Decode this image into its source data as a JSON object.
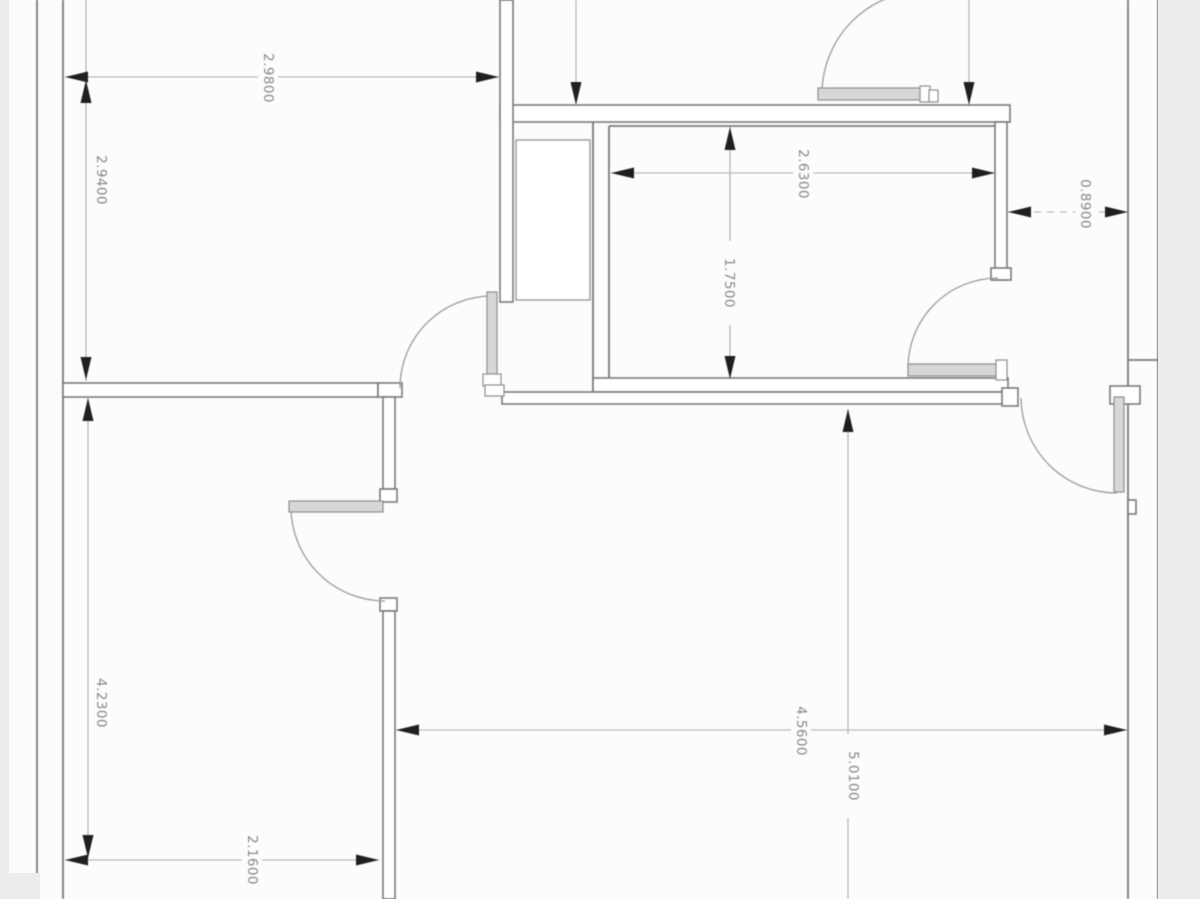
{
  "title": "floor-plan-drawing",
  "colors": {
    "background": "#fcfcfc",
    "paper_edge": "#ececec",
    "wall_stroke": "#7a7a7a",
    "thin_line": "#9b9b9b",
    "dim_line": "#aeaeae",
    "arrow": "#1f1f1f",
    "text": "#878787",
    "leaf_fill": "#d7d7d7",
    "leaf_stroke": "#8f8f8f"
  },
  "paper_edges": [
    {
      "name": "paper-edge-left",
      "x": 0,
      "y": 0,
      "w": 9,
      "h": 899
    },
    {
      "name": "paper-edge-right",
      "x": 1158,
      "y": 0,
      "w": 42,
      "h": 899
    },
    {
      "name": "paper-edge-bottom-left",
      "x": 0,
      "y": 873,
      "w": 40,
      "h": 26
    }
  ],
  "wall_lines": [
    {
      "name": "outer-left-wall-outer-line",
      "x1": 37,
      "y1": 0,
      "x2": 37,
      "y2": 899
    },
    {
      "name": "outer-left-wall-inner-line",
      "x1": 63,
      "y1": 0,
      "x2": 63,
      "y2": 899
    },
    {
      "name": "outer-right-wall-inner-line",
      "x1": 1128,
      "y1": 0,
      "x2": 1128,
      "y2": 899
    },
    {
      "name": "outer-right-wall-outer-line",
      "x1": 1158,
      "y1": 0,
      "x2": 1158,
      "y2": 899
    },
    {
      "name": "bathroom-top-inner-line",
      "x1": 609,
      "y1": 126,
      "x2": 995,
      "y2": 126
    },
    {
      "name": "bathroom-left-inner-line",
      "x1": 609,
      "y1": 126,
      "x2": 609,
      "y2": 380
    },
    {
      "name": "bathroom-left-outer-line",
      "x1": 593,
      "y1": 122,
      "x2": 593,
      "y2": 392
    },
    {
      "name": "right-wall-tick",
      "x1": 1128,
      "y1": 360,
      "x2": 1158,
      "y2": 360
    }
  ],
  "wall_rects": [
    {
      "name": "top-wall",
      "x": 500,
      "y": 105,
      "w": 510,
      "h": 17
    },
    {
      "name": "top-vertical-wall",
      "x": 500,
      "y": 0,
      "w": 13,
      "h": 302
    },
    {
      "name": "bedroom1-bottom-wall",
      "x": 63,
      "y": 383,
      "w": 315,
      "h": 14
    },
    {
      "name": "bedroom1-door-jamb",
      "x": 378,
      "y": 383,
      "w": 24,
      "h": 14
    },
    {
      "name": "middle-vertical-wall-upper",
      "x": 383,
      "y": 397,
      "w": 12,
      "h": 92
    },
    {
      "name": "bedroom2-door-top-jamb",
      "x": 380,
      "y": 489,
      "w": 17,
      "h": 13
    },
    {
      "name": "bedroom2-door-bottom-jamb",
      "x": 380,
      "y": 598,
      "w": 17,
      "h": 13
    },
    {
      "name": "middle-vertical-wall-lower",
      "x": 383,
      "y": 611,
      "w": 12,
      "h": 288
    },
    {
      "name": "bathroom-bottom-wall",
      "x": 593,
      "y": 378,
      "w": 415,
      "h": 14
    },
    {
      "name": "corridor-wall",
      "x": 502,
      "y": 392,
      "w": 514,
      "h": 12
    },
    {
      "name": "corridor-wall-right-jamb",
      "x": 1002,
      "y": 388,
      "w": 16,
      "h": 18
    },
    {
      "name": "bathroom-right-wall",
      "x": 995,
      "y": 122,
      "w": 12,
      "h": 158
    },
    {
      "name": "bathroom-right-wall-jamb",
      "x": 991,
      "y": 268,
      "w": 20,
      "h": 12
    },
    {
      "name": "entry-door-hinge-stub",
      "x": 1110,
      "y": 386,
      "w": 30,
      "h": 18
    },
    {
      "name": "right-wall-step",
      "x": 1128,
      "y": 500,
      "w": 8,
      "h": 14
    }
  ],
  "closet": {
    "name": "closet",
    "x": 516,
    "y": 140,
    "w": 74,
    "h": 160
  },
  "doors": [
    {
      "name": "door-top-right-room",
      "leaf": {
        "x": 818,
        "y": 88,
        "w": 104,
        "h": 12
      },
      "blocks": [
        {
          "x": 920,
          "y": 86,
          "w": 10,
          "h": 16
        },
        {
          "x": 929,
          "y": 90,
          "w": 9,
          "h": 12
        }
      ],
      "arc": "M 822,94 A 103,103 0 0 1 925,-9"
    },
    {
      "name": "door-bedroom1",
      "leaf": {
        "x": 487,
        "y": 292,
        "w": 10,
        "h": 92
      },
      "blocks": [
        {
          "x": 483,
          "y": 374,
          "w": 18,
          "h": 12
        },
        {
          "x": 485,
          "y": 385,
          "w": 19,
          "h": 11
        }
      ],
      "arc": "M 492,296 A 92,92 0 0 0 400,388"
    },
    {
      "name": "door-bedroom2",
      "leaf": {
        "x": 289,
        "y": 501,
        "w": 94,
        "h": 11
      },
      "blocks": [],
      "arc": "M 291,507 A 94,94 0 0 0 385,601"
    },
    {
      "name": "door-bathroom",
      "leaf": {
        "x": 908,
        "y": 364,
        "w": 90,
        "h": 12
      },
      "blocks": [
        {
          "x": 996,
          "y": 360,
          "w": 11,
          "h": 20
        }
      ],
      "arc": "M 908,368 A 90,90 0 0 1 998,278"
    },
    {
      "name": "door-entry",
      "leaf": {
        "x": 1114,
        "y": 397,
        "w": 10,
        "h": 95
      },
      "blocks": [],
      "arc": "M 1021,398 A 96,96 0 0 0 1117,493"
    }
  ],
  "dimensions": [
    {
      "name": "dim-top-room-width",
      "value": "2.9800",
      "dashed": false,
      "line": {
        "x1": 65,
        "y1": 77,
        "x2": 499,
        "y2": 77
      },
      "arrows": [
        {
          "x": 65,
          "y": 77,
          "dir": "left"
        },
        {
          "x": 499,
          "y": 77,
          "dir": "right"
        }
      ],
      "label": {
        "x": 268,
        "y": 78
      }
    },
    {
      "name": "dim-top-room-height",
      "value": "2.9400",
      "dashed": false,
      "line": {
        "x1": 86,
        "y1": 0,
        "x2": 86,
        "y2": 381
      },
      "arrows": [
        {
          "x": 86,
          "y": 80,
          "dir": "up"
        },
        {
          "x": 86,
          "y": 380,
          "dir": "down"
        }
      ],
      "label": {
        "x": 101,
        "y": 180
      }
    },
    {
      "name": "dim-bathroom-width",
      "value": "2.6300",
      "dashed": false,
      "line": {
        "x1": 611,
        "y1": 173,
        "x2": 995,
        "y2": 173
      },
      "arrows": [
        {
          "x": 611,
          "y": 173,
          "dir": "left"
        },
        {
          "x": 995,
          "y": 173,
          "dir": "right"
        }
      ],
      "label": {
        "x": 803,
        "y": 174
      }
    },
    {
      "name": "dim-bathroom-height",
      "value": "1.7500",
      "dashed": false,
      "line": {
        "x1": 730,
        "y1": 127,
        "x2": 730,
        "y2": 379
      },
      "arrows": [
        {
          "x": 730,
          "y": 127,
          "dir": "up"
        },
        {
          "x": 730,
          "y": 379,
          "dir": "down"
        }
      ],
      "label": {
        "x": 729,
        "y": 283
      }
    },
    {
      "name": "dim-side-gap",
      "value": "0.8900",
      "dashed": true,
      "line": {
        "x1": 1008,
        "y1": 212,
        "x2": 1128,
        "y2": 212
      },
      "arrows": [
        {
          "x": 1008,
          "y": 212,
          "dir": "left"
        },
        {
          "x": 1128,
          "y": 212,
          "dir": "right"
        }
      ],
      "label": {
        "x": 1085,
        "y": 204
      }
    },
    {
      "name": "dim-bedroom2-height",
      "value": "4.2300",
      "dashed": false,
      "line": {
        "x1": 88,
        "y1": 398,
        "x2": 88,
        "y2": 858
      },
      "arrows": [
        {
          "x": 88,
          "y": 398,
          "dir": "up"
        },
        {
          "x": 88,
          "y": 858,
          "dir": "down"
        }
      ],
      "label": {
        "x": 101,
        "y": 703
      }
    },
    {
      "name": "dim-bedroom2-width",
      "value": "2.1600",
      "dashed": false,
      "line": {
        "x1": 65,
        "y1": 860,
        "x2": 379,
        "y2": 860
      },
      "arrows": [
        {
          "x": 65,
          "y": 860,
          "dir": "left"
        },
        {
          "x": 379,
          "y": 860,
          "dir": "right"
        }
      ],
      "label": {
        "x": 252,
        "y": 860
      }
    },
    {
      "name": "dim-living-width",
      "value": "4.5600",
      "dashed": false,
      "line": {
        "x1": 396,
        "y1": 730,
        "x2": 1127,
        "y2": 730
      },
      "arrows": [
        {
          "x": 396,
          "y": 730,
          "dir": "left"
        },
        {
          "x": 1127,
          "y": 730,
          "dir": "right"
        }
      ],
      "label": {
        "x": 801,
        "y": 731
      }
    },
    {
      "name": "dim-living-height",
      "value": "5.0100",
      "dashed": false,
      "line": {
        "x1": 848,
        "y1": 409,
        "x2": 848,
        "y2": 899
      },
      "arrows": [
        {
          "x": 848,
          "y": 409,
          "dir": "up"
        }
      ],
      "label": {
        "x": 853,
        "y": 776
      }
    }
  ],
  "cut_dimension_lines": [
    {
      "name": "cut-dim-line-left",
      "line": {
        "x1": 576,
        "y1": 0,
        "x2": 576,
        "y2": 102
      },
      "arrow": {
        "x": 576,
        "y": 105,
        "dir": "down"
      }
    },
    {
      "name": "cut-dim-line-right",
      "line": {
        "x1": 969,
        "y1": 0,
        "x2": 969,
        "y2": 102
      },
      "arrow": {
        "x": 969,
        "y": 105,
        "dir": "down"
      }
    }
  ]
}
